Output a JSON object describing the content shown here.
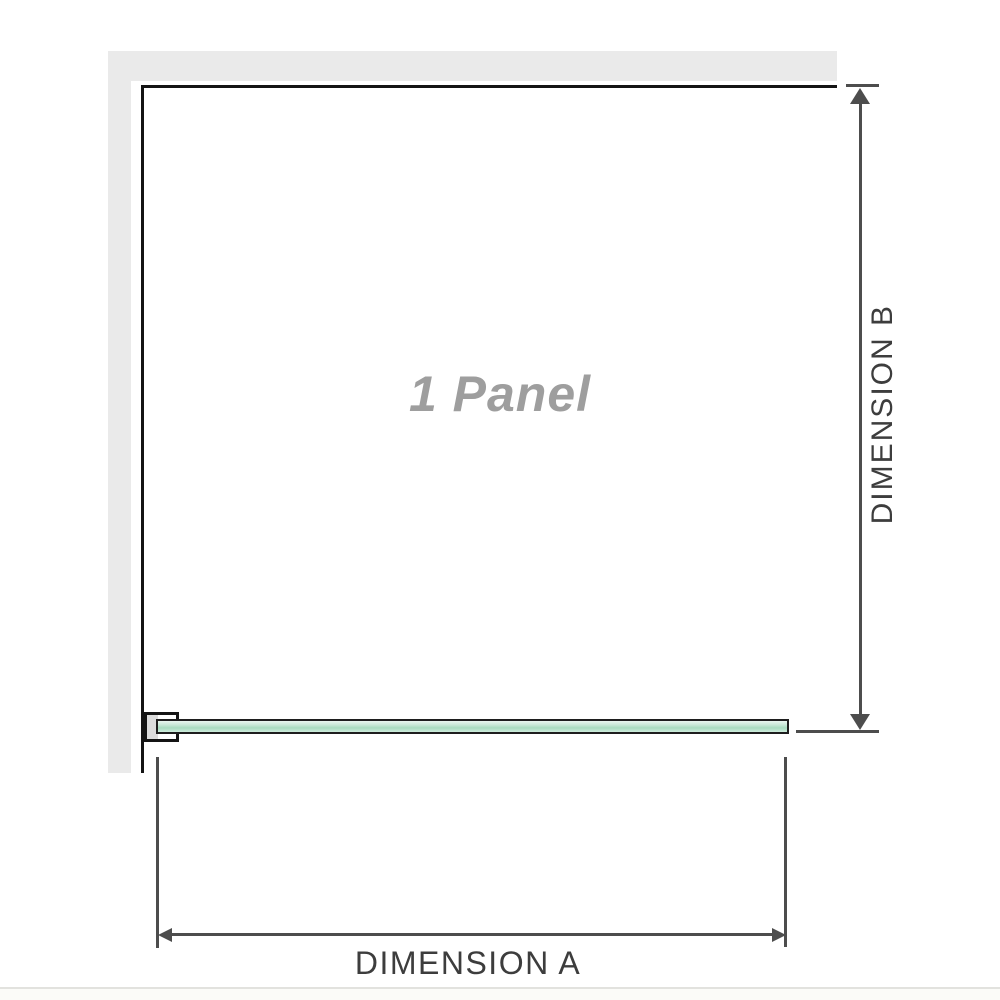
{
  "diagram": {
    "panel_label": "1 Panel",
    "dimension_a": {
      "label": "DIMENSION A"
    },
    "dimension_b": {
      "label": "DIMENSION B"
    }
  },
  "colors": {
    "background": "#ffffff",
    "wall_gray": "#eaeaea",
    "outline_black": "#141414",
    "dimension_gray": "#4d4d4d",
    "glass_green": "#a8dcc0",
    "label_text": "#3d3d3d",
    "panel_label_gray": "#9e9e9e",
    "bracket_fill": "#ffffff",
    "bracket_inner_gray": "#dcdcdc",
    "footer_divider": "#e2e2de",
    "footer_strip": "#fbfbf8"
  }
}
